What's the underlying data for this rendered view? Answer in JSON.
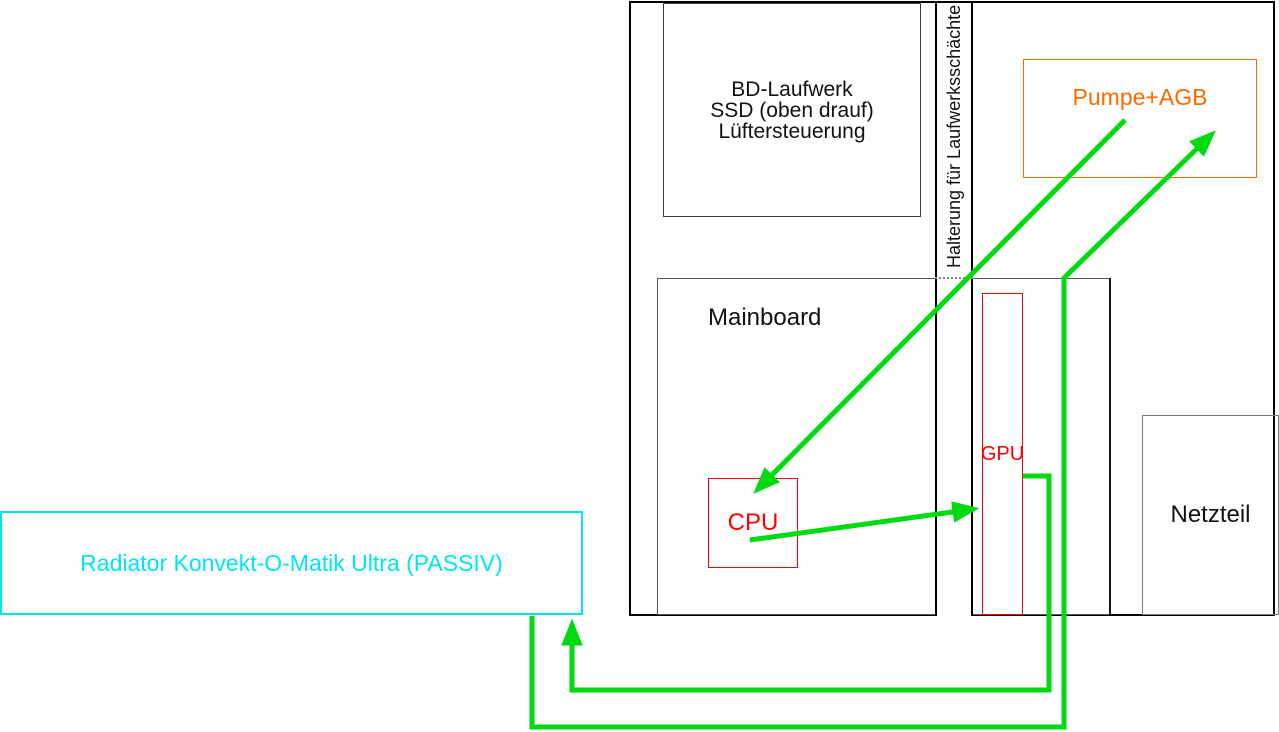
{
  "colors": {
    "green": "#00da10",
    "red": "#ff0000",
    "orange": "#ff6a00",
    "cyan": "#00e6ef",
    "outline": "#000000"
  },
  "nodes": {
    "drive_bay": {
      "line1": "BD-Laufwerk",
      "line2": "SSD (oben drauf)",
      "line3": "Lüftersteuerung"
    },
    "drive_mount": {
      "label": "Halterung für Laufwerksschächte"
    },
    "pump": {
      "label": "Pumpe+AGB"
    },
    "mainboard": {
      "label": "Mainboard"
    },
    "cpu": {
      "label": "CPU"
    },
    "gpu": {
      "label": "GPU"
    },
    "psu": {
      "label": "Netzteil"
    },
    "radiator": {
      "label": "Radiator Konvekt-O-Matik Ultra (PASSIV)"
    }
  },
  "flows": [
    {
      "from": "Pumpe+AGB",
      "to": "CPU"
    },
    {
      "from": "CPU",
      "to": "GPU"
    },
    {
      "from": "GPU",
      "to": "Radiator"
    },
    {
      "from": "Radiator",
      "to": "Pumpe+AGB"
    }
  ]
}
